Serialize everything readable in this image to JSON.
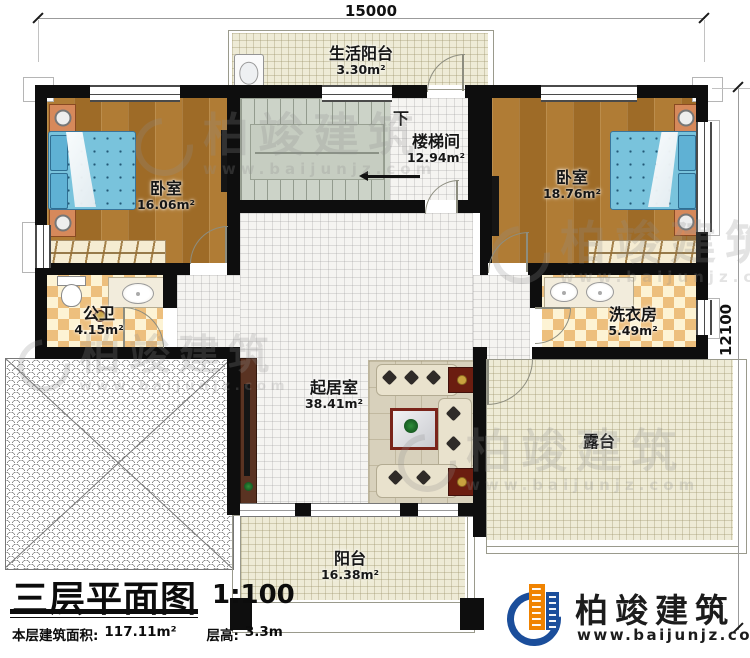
{
  "drawing": {
    "title": "三层平面图",
    "scale": "1:100",
    "stats": {
      "area_label": "本层建筑面积:",
      "area_value": "117.11m²",
      "height_label": "层高:",
      "height_value": "3.3m"
    },
    "dimensions": {
      "top": "15000",
      "right": "12100"
    }
  },
  "rooms": {
    "life_balcony": {
      "name": "生活阳台",
      "area": "3.30m²"
    },
    "stairwell": {
      "name": "楼梯间",
      "area": "12.94m²",
      "direction": "下"
    },
    "bedroom_left": {
      "name": "卧室",
      "area": "16.06m²"
    },
    "bedroom_right": {
      "name": "卧室",
      "area": "18.76m²"
    },
    "bathroom": {
      "name": "公卫",
      "area": "4.15m²"
    },
    "laundry": {
      "name": "洗衣房",
      "area": "5.49m²"
    },
    "living": {
      "name": "起居室",
      "area": "38.41m²"
    },
    "terrace": {
      "name": "露台"
    },
    "balcony": {
      "name": "阳台",
      "area": "16.38m²"
    }
  },
  "branding": {
    "company": "柏竣建筑",
    "website": "www.baijunjz.com"
  },
  "watermark": {
    "company": "柏竣建筑",
    "website": "www.baijunjz.com"
  },
  "colors": {
    "wall": "#0e0e0e",
    "wood": "#a9752e",
    "tile_beige": "#eeebd6",
    "checker": "#edbf7d",
    "brand_blue": "#1b4e9b",
    "brand_orange": "#f08300",
    "bed_blue": "#79c3dc"
  }
}
